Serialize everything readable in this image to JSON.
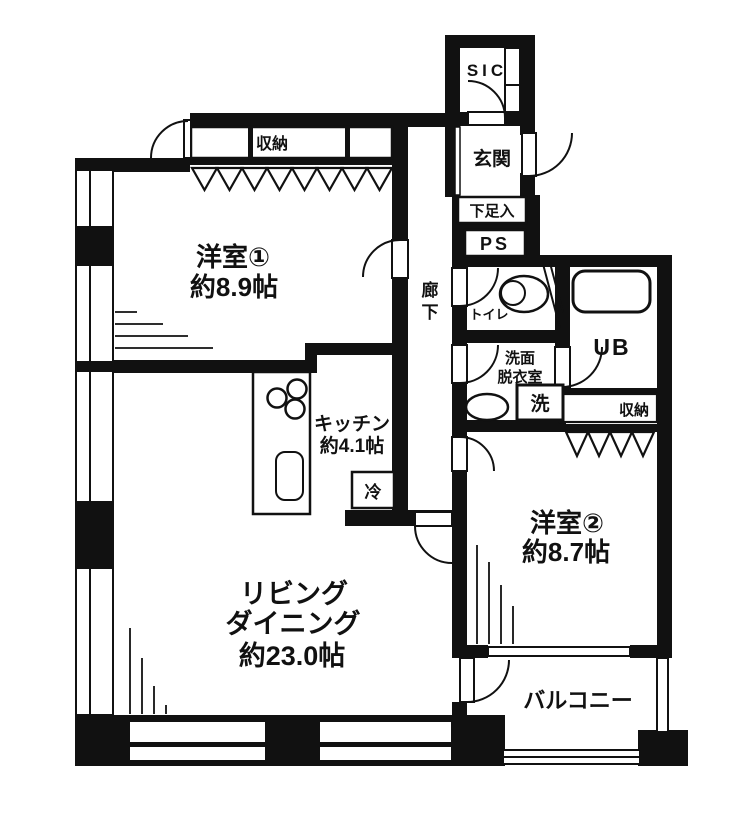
{
  "plan": {
    "title": "apartment-floor-plan",
    "colors": {
      "wall": "#111111",
      "background": "#ffffff",
      "line": "#1a1a1a"
    },
    "rooms": {
      "sic": {
        "label": "SIC"
      },
      "entrance": {
        "label": "玄関"
      },
      "shoe_cabinet": {
        "label": "下足入"
      },
      "pipe_space": {
        "label": "PS"
      },
      "toilet": {
        "label": "トイレ"
      },
      "bath": {
        "label": "UB"
      },
      "washroom": {
        "line1": "洗面",
        "line2": "脱衣室"
      },
      "laundry": {
        "label": "洗"
      },
      "closet1": {
        "label": "収納"
      },
      "closet2": {
        "label": "収納"
      },
      "hallway": {
        "char1": "廊",
        "char2": "下"
      },
      "bedroom1": {
        "name": "洋室①",
        "size": "約8.9帖"
      },
      "bedroom2": {
        "name": "洋室②",
        "size": "約8.7帖"
      },
      "kitchen": {
        "name": "キッチン",
        "size": "約4.1帖"
      },
      "refrigerator": {
        "label": "冷"
      },
      "living_dining": {
        "name1": "リビング",
        "name2": "ダイニング",
        "size": "約23.0帖"
      },
      "balcony": {
        "label": "バルコニー"
      }
    }
  }
}
